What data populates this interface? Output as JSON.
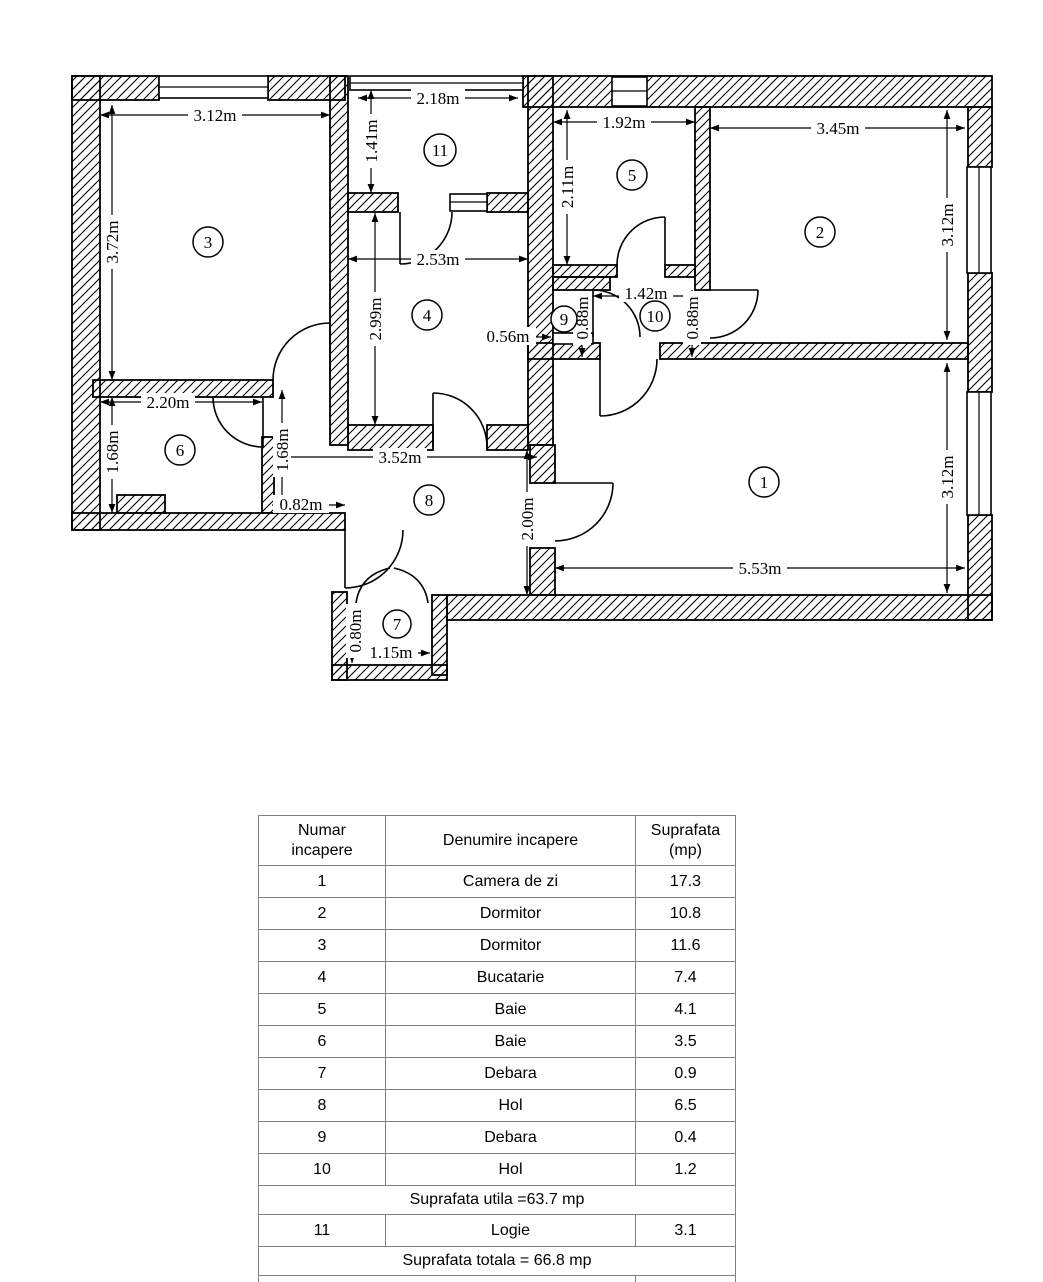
{
  "plan": {
    "room_numbers": [
      "1",
      "2",
      "3",
      "4",
      "5",
      "6",
      "7",
      "8",
      "9",
      "10",
      "11"
    ],
    "dims": {
      "r3_w": "3.12m",
      "r3_h": "3.72m",
      "r11_w": "2.18m",
      "r11_h": "1.41m",
      "r5_w": "1.92m",
      "r5_h": "2.11m",
      "r2_w": "3.45m",
      "r2_h": "3.12m",
      "r4_w": "2.53m",
      "r4_h": "2.99m",
      "r9_w": "0.56m",
      "r10_w": "1.42m",
      "r9_h": "0.88m",
      "r10_h": "0.88m",
      "r6_w": "2.20m",
      "r6_hl": "1.68m",
      "r6_hr": "1.68m",
      "entry_w": "0.82m",
      "r8_w": "3.52m",
      "r8_h": "2.00m",
      "r1_w": "5.53m",
      "r1_h": "3.12m",
      "r7_h": "0.80m",
      "r7_w": "1.15m"
    }
  },
  "table": {
    "headers": [
      "Numar incapere",
      "Denumire incapere",
      "Suprafata (mp)"
    ],
    "rows": [
      {
        "nr": "1",
        "name": "Camera de zi",
        "area": "17.3"
      },
      {
        "nr": "2",
        "name": "Dormitor",
        "area": "10.8"
      },
      {
        "nr": "3",
        "name": "Dormitor",
        "area": "11.6"
      },
      {
        "nr": "4",
        "name": "Bucatarie",
        "area": "7.4"
      },
      {
        "nr": "5",
        "name": "Baie",
        "area": "4.1"
      },
      {
        "nr": "6",
        "name": "Baie",
        "area": "3.5"
      },
      {
        "nr": "7",
        "name": "Debara",
        "area": "0.9"
      },
      {
        "nr": "8",
        "name": "Hol",
        "area": "6.5"
      },
      {
        "nr": "9",
        "name": "Debara",
        "area": "0.4"
      },
      {
        "nr": "10",
        "name": "Hol",
        "area": "1.2"
      }
    ],
    "suprafata_utila": "Suprafata utila =63.7 mp",
    "logie_row": {
      "nr": "11",
      "name": "Logie",
      "area": "3.1"
    },
    "suprafata_totala": "Suprafata totala = 66.8 mp",
    "footer_label": "Data"
  }
}
